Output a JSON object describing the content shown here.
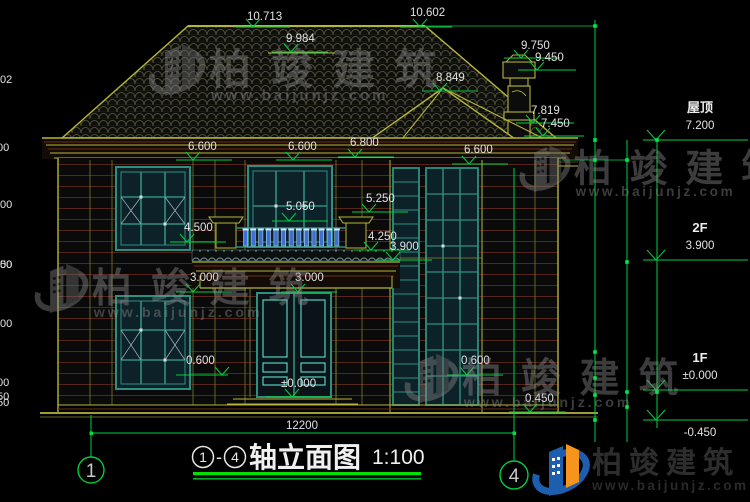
{
  "drawing": {
    "title": {
      "axis_from": "1",
      "axis_to": "4",
      "separator": "-",
      "name": "轴立面图",
      "scale": "1:100"
    },
    "axis_bubbles": {
      "left": "1",
      "right": "4"
    },
    "elevation_marks": {
      "m10713": "10.713",
      "m9984": "9.984",
      "m10602": "10.602",
      "m9750": "9.750",
      "m9450": "9.450",
      "m8849": "8.849",
      "m7819": "7.819",
      "m7450": "7.450",
      "e6600a": "6.600",
      "e6600b": "6.600",
      "e6800": "6.800",
      "e6600c": "6.600",
      "m5250": "5.250",
      "m5050": "5.050",
      "m4500": "4.500",
      "m4250": "4.250",
      "m3900": "3.900",
      "m3000a": "3.000",
      "m3000b": "3.000",
      "zero": "±0.000",
      "m0600a": "0.600",
      "m0600b": "0.600",
      "m0450": "0.450"
    },
    "right_levels": {
      "roof_label": "屋顶",
      "roof_value": "7.200",
      "f2_label": "2F",
      "f2_value": "3.900",
      "f1_label": "1F",
      "f1_value": "±0.000",
      "ground_value": "-0.450"
    },
    "dimensions": {
      "total_width": "12200",
      "chain_a": [
        "3402",
        "600",
        "6000",
        "600",
        "450"
      ],
      "chain_b": [
        "3300",
        "3900",
        "450"
      ],
      "chain_c": [
        "7650"
      ]
    }
  },
  "watermark": {
    "brand": "柏竣建筑",
    "url": "www.baijunjz.com"
  },
  "footer_logo": {
    "brand": "柏竣建筑",
    "url": "www.baijunjz.com"
  },
  "colors": {
    "dim_green": "#00cf3f",
    "underline_green": "#00e000",
    "line_yellow": "#b5b53a",
    "line_red": "#6b2e1e",
    "frame_teal": "#2f8f7f",
    "panel_cyan": "#56d0c0",
    "baluster_blue": "#3f6fd0",
    "logo_blue": "#1d5fae",
    "logo_orange": "#f7941d"
  }
}
